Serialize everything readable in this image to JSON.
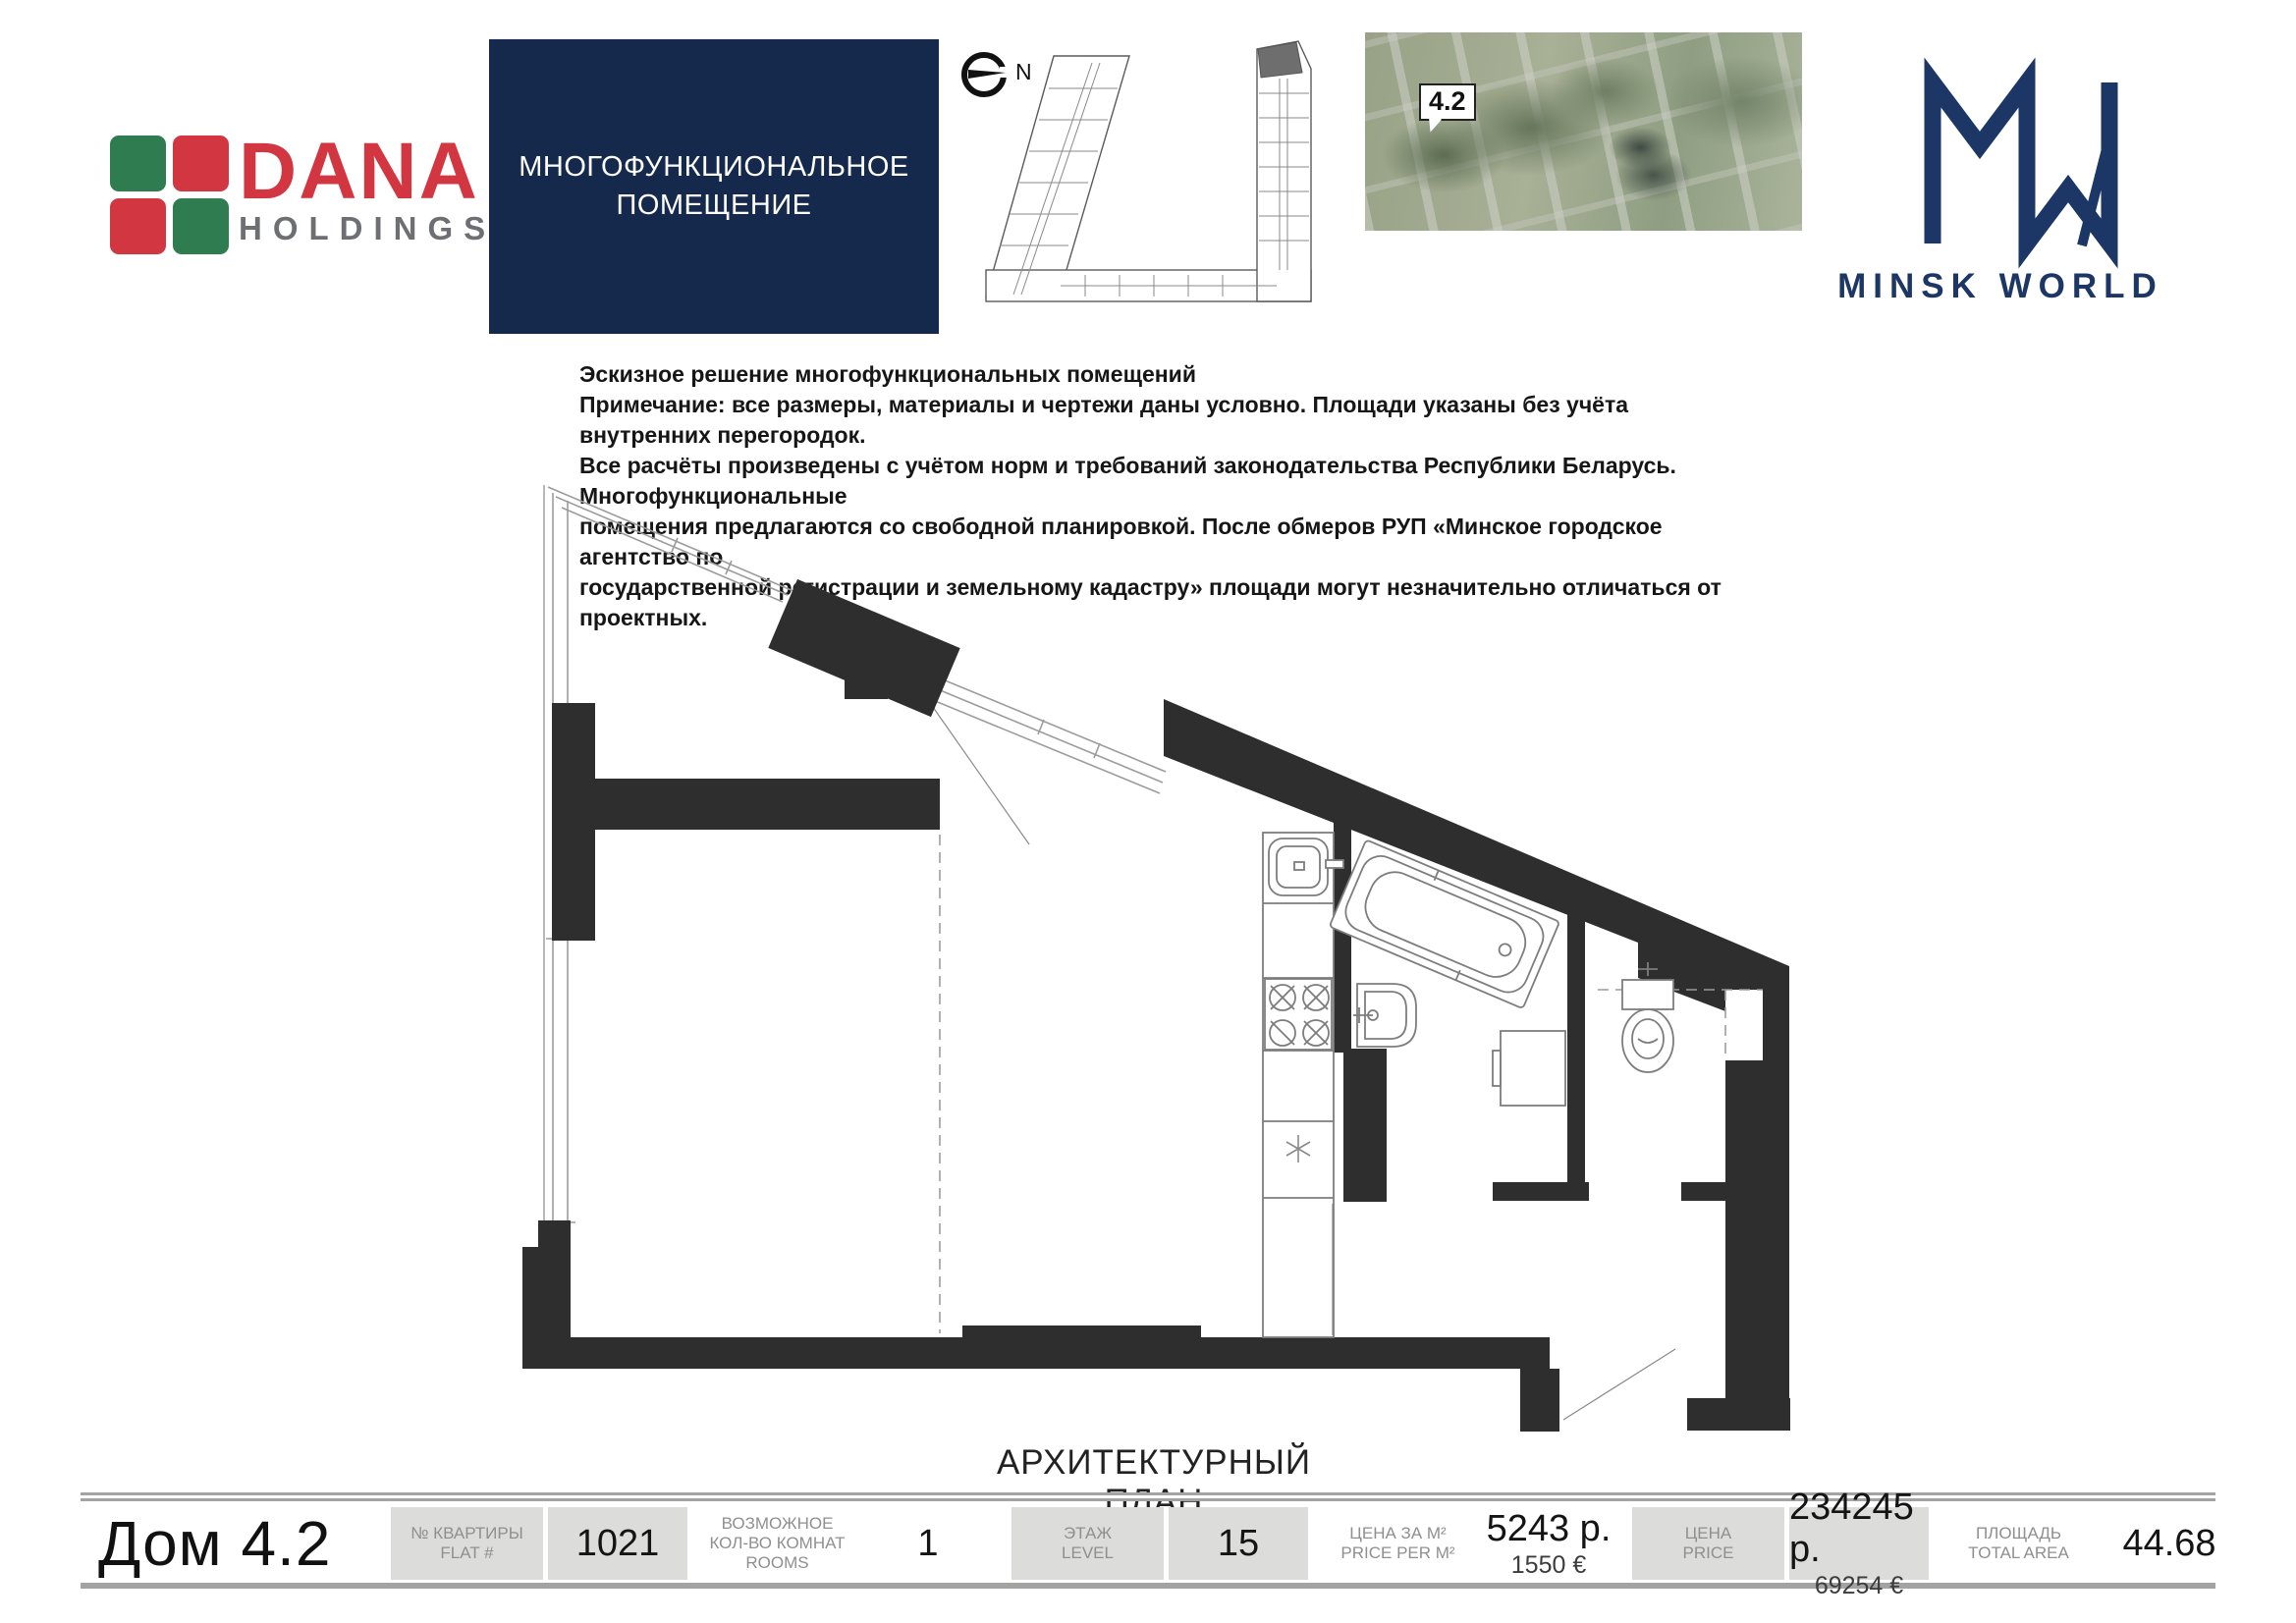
{
  "header": {
    "dana_logo": {
      "word": "DANA",
      "sub": "HOLDINGS"
    },
    "unit_type_box": {
      "line1": "МНОГОФУНКЦИОНАЛЬНОЕ",
      "line2": "ПОМЕЩЕНИЕ"
    },
    "compass_label": "N",
    "aerial_badge": "4.2",
    "brand_wordmark": "MINSK WORLD"
  },
  "notes": {
    "lines": [
      "Эскизное решение многофункциональных помещений",
      "Примечание: все размеры, материалы и чертежи даны условно. Площади указаны без учёта внутренних перегородок.",
      "Все расчёты произведены с учётом норм и требований законодательства Республики Беларусь. Многофункциональные",
      "помещения предлагаются со свободной планировкой. После обмеров РУП «Минское городское агентство по",
      "государственной регистрации и земельному кадастру» площади могут незначительно отличаться от проектных."
    ]
  },
  "plan": {
    "caption": "АРХИТЕКТУРНЫЙ ПЛАН"
  },
  "footer": {
    "title": "Дом 4.2",
    "fields": [
      {
        "label_ru": "№ КВАРТИРЫ",
        "label_en": "FLAT #",
        "value": "1021",
        "value_sub": "",
        "gray": true
      },
      {
        "label_ru": "ВОЗМОЖНОЕ КОЛ-ВО КОМНАТ",
        "label_en": "ROOMS",
        "value": "1",
        "value_sub": "",
        "gray": false
      },
      {
        "label_ru": "ЭТАЖ",
        "label_en": "LEVEL",
        "value": "15",
        "value_sub": "",
        "gray": true
      },
      {
        "label_ru": "ЦЕНА ЗА М²",
        "label_en": "PRICE PER M²",
        "value": "5243 р.",
        "value_sub": "1550 €",
        "gray": false
      },
      {
        "label_ru": "ЦЕНА",
        "label_en": "PRICE",
        "value": "234245 р.",
        "value_sub": "69254 €",
        "gray": true
      },
      {
        "label_ru": "ПЛОЩАДЬ",
        "label_en": "TOTAL AREA",
        "value": "44.68",
        "value_sub": "",
        "gray": false
      }
    ]
  },
  "colors": {
    "navy_box": "#15294d",
    "mw_navy": "#1c3766",
    "dana_red": "#d23640",
    "dana_green": "#2e7c50",
    "holdings_gray": "#6e6f72",
    "wall_black": "#2e2e2e",
    "gray_cell": "#dcdcda",
    "label_gray": "#8f8f8f"
  }
}
